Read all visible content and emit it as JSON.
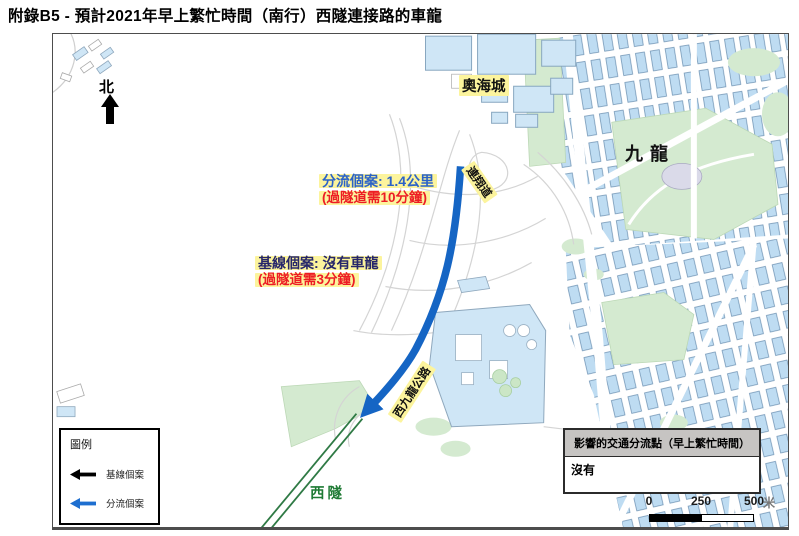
{
  "title": "附錄B5 - 預計2021年早上繁忙時間（南行）西隧連接路的車龍",
  "map": {
    "north_label": "北",
    "labels": {
      "olympian_city": "奧海城",
      "kowloon": "九龍",
      "lin_cheung_road": "連翔道",
      "west_kowloon_highway": "西九龍公路",
      "western_tunnel": "西隧"
    },
    "annotations": {
      "diversion_case": "分流個案: 1.4公里",
      "diversion_time": "(過隧道需10分鐘)",
      "baseline_case": "基線個案: 沒有車龍",
      "baseline_time": "(過隧道需3分鐘)"
    },
    "legend": {
      "title": "圖例",
      "items": [
        {
          "label": "基線個案",
          "color": "#000000"
        },
        {
          "label": "分流個案",
          "color": "#1e6fd0"
        }
      ]
    },
    "impact_table": {
      "header": "影響的交通分流點（早上繁忙時間）",
      "body": "沒有"
    },
    "scalebar": {
      "ticks": [
        "0",
        "250",
        "500"
      ],
      "unit": "米"
    }
  },
  "colors": {
    "queue_arrow_blue": "#1565c4",
    "diversion_blue": "#1e6fd0",
    "baseline_black": "#000000",
    "highlight_yellow": "#fcf49d",
    "diversion_text_blue": "#2b62c8",
    "baseline_text_navy": "#26266a",
    "time_text_red": "#ed1c24",
    "tunnel_green": "#2f7a45",
    "tunnel_label_green": "#1e7a34",
    "building_fill": "#cfe6f6",
    "park_fill": "#d4ead0",
    "table_header_bg": "#c6c4c2"
  }
}
